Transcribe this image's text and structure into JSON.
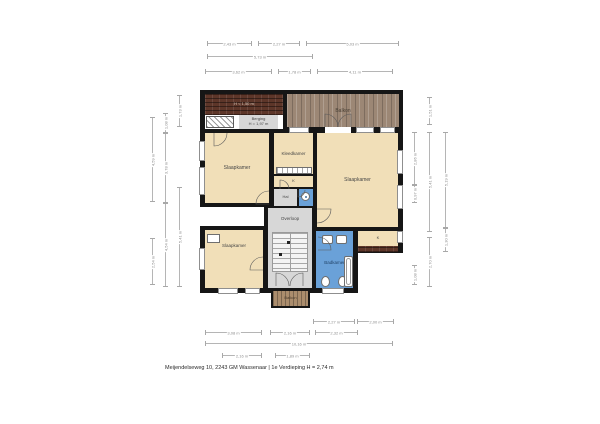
{
  "meta": {
    "footer": "Meijendelseweg 10, 2243 GM Wassenaar | 1e Verdieping H = 2,74 m"
  },
  "colors": {
    "wall": "#161616",
    "room": "#f1dfb8",
    "gray": "#d7d7d7",
    "blue": "#6aa1d8",
    "tile": "#5d3629",
    "wood": "#9c8775",
    "wood2": "#ab8d6d"
  },
  "walls": [
    {
      "x": 200,
      "y": 90,
      "w": 203,
      "h": 163
    },
    {
      "x": 200,
      "y": 250,
      "w": 158,
      "h": 43
    },
    {
      "x": 271,
      "y": 291,
      "w": 39,
      "h": 17
    }
  ],
  "areas": [
    {
      "name": "roof-low",
      "type": "tile",
      "x": 205,
      "y": 94,
      "w": 78,
      "h": 21,
      "label": "H < 1,50 m",
      "fs": 4,
      "lc": "#d8c8ba"
    },
    {
      "name": "storage-strip",
      "type": "plain-white",
      "x": 205,
      "y": 115,
      "w": 78,
      "h": 14
    },
    {
      "name": "berging",
      "type": "gray",
      "x": 239,
      "y": 115,
      "w": 39,
      "h": 14,
      "label": "Berging",
      "label2": "H = 1,97 m",
      "fs": 4
    },
    {
      "name": "balkon-top",
      "type": "wood",
      "x": 287,
      "y": 94,
      "w": 112,
      "h": 33,
      "label": "Balkon",
      "fs": 5,
      "lc": "#4a4136"
    },
    {
      "name": "slaapkamer-1",
      "type": "room",
      "x": 205,
      "y": 133,
      "w": 64,
      "h": 70,
      "label": "Slaapkamer",
      "fs": 5
    },
    {
      "name": "kleedkamer",
      "type": "room",
      "x": 274,
      "y": 133,
      "w": 39,
      "h": 41,
      "label": "Kleedkamer",
      "fs": 4.5
    },
    {
      "name": "kast-1",
      "type": "room",
      "x": 274,
      "y": 176,
      "w": 39,
      "h": 11,
      "label": "K",
      "fs": 4
    },
    {
      "name": "hal",
      "type": "gray",
      "x": 274,
      "y": 189,
      "w": 23,
      "h": 17,
      "label": "Hal",
      "fs": 4
    },
    {
      "name": "toilet",
      "type": "blue",
      "x": 299,
      "y": 189,
      "w": 14,
      "h": 17
    },
    {
      "name": "slaapkamer-2",
      "type": "room",
      "x": 317,
      "y": 133,
      "w": 81,
      "h": 94,
      "label": "Slaapkamer",
      "fs": 5
    },
    {
      "name": "exterior-notch",
      "type": "plain-white",
      "x": 200,
      "y": 207,
      "w": 64,
      "h": 19
    },
    {
      "name": "overloop",
      "type": "gray",
      "x": 268,
      "y": 208,
      "w": 44,
      "h": 80,
      "label": "Overloop",
      "fs": 4.5,
      "labelDy": -29
    },
    {
      "name": "slaapkamer-3",
      "type": "room",
      "x": 205,
      "y": 230,
      "w": 58,
      "h": 58,
      "label": "Slaapkamer",
      "fs": 4.5,
      "labelDy": -13
    },
    {
      "name": "badkamer",
      "type": "blue",
      "x": 316,
      "y": 231,
      "w": 37,
      "h": 57,
      "label": "Badkamer",
      "fs": 4.5,
      "labelDy": 3,
      "lc": "#24466b"
    },
    {
      "name": "kast-2",
      "type": "room",
      "x": 358,
      "y": 231,
      "w": 40,
      "h": 15,
      "label": "K",
      "fs": 4
    },
    {
      "name": "kast-2-roof",
      "type": "tile",
      "x": 358,
      "y": 246,
      "w": 40,
      "h": 6
    },
    {
      "name": "balkon-bottom",
      "type": "wood2",
      "x": 273,
      "y": 291,
      "w": 35,
      "h": 15,
      "label": "Balkon",
      "fs": 4,
      "lc": "#4a3c2c"
    }
  ],
  "fixtures": [
    {
      "type": "hatch",
      "x": 206,
      "y": 116,
      "w": 28,
      "h": 12
    },
    {
      "type": "closet",
      "x": 276,
      "y": 167,
      "w": 36,
      "h": 7
    },
    {
      "type": "circle",
      "x": 301,
      "y": 192,
      "w": 9,
      "h": 9
    },
    {
      "type": "box",
      "x": 207,
      "y": 234,
      "w": 13,
      "h": 9
    },
    {
      "type": "stairs",
      "x": 272,
      "y": 232,
      "w": 36,
      "h": 40
    },
    {
      "type": "dot",
      "x": 287,
      "y": 241,
      "w": 3,
      "h": 3
    },
    {
      "type": "dot",
      "x": 279,
      "y": 253,
      "w": 3,
      "h": 3
    },
    {
      "type": "roundbox",
      "x": 322,
      "y": 235,
      "w": 11,
      "h": 9
    },
    {
      "type": "roundbox",
      "x": 336,
      "y": 235,
      "w": 11,
      "h": 9
    },
    {
      "type": "oval",
      "x": 321,
      "y": 276,
      "w": 9,
      "h": 11
    },
    {
      "type": "oval",
      "x": 338,
      "y": 276,
      "w": 9,
      "h": 11
    },
    {
      "type": "tub",
      "x": 344,
      "y": 256,
      "w": 9,
      "h": 31
    }
  ],
  "windows": [
    {
      "x": 199,
      "y": 141,
      "w": 6,
      "h": 20
    },
    {
      "x": 199,
      "y": 167,
      "w": 6,
      "h": 28
    },
    {
      "x": 199,
      "y": 248,
      "w": 6,
      "h": 22
    },
    {
      "x": 218,
      "y": 288,
      "w": 20,
      "h": 6
    },
    {
      "x": 245,
      "y": 288,
      "w": 15,
      "h": 6
    },
    {
      "x": 322,
      "y": 288,
      "w": 22,
      "h": 6
    },
    {
      "x": 397,
      "y": 150,
      "w": 6,
      "h": 24
    },
    {
      "x": 397,
      "y": 185,
      "w": 6,
      "h": 24
    },
    {
      "x": 397,
      "y": 231,
      "w": 6,
      "h": 12
    },
    {
      "x": 289,
      "y": 127,
      "w": 20,
      "h": 6
    },
    {
      "x": 356,
      "y": 127,
      "w": 18,
      "h": 6
    },
    {
      "x": 380,
      "y": 127,
      "w": 15,
      "h": 6
    },
    {
      "x": 325,
      "y": 127,
      "w": 26,
      "h": 6,
      "frame": false
    }
  ],
  "doors": [
    {
      "name": "slaapkamer-1-top",
      "px": 214,
      "py": 133,
      "r": 13,
      "a0": 90,
      "a1": 0
    },
    {
      "name": "slaapkamer-1-hal",
      "px": 269,
      "py": 204,
      "r": 13,
      "a0": 180,
      "a1": 270
    },
    {
      "name": "balkon-left",
      "px": 325,
      "py": 127,
      "r": 13,
      "a0": 270,
      "a1": 360
    },
    {
      "name": "balkon-right",
      "px": 351,
      "py": 127,
      "r": 13,
      "a0": 270,
      "a1": 180
    },
    {
      "name": "slaapkamer-2",
      "px": 317,
      "py": 209,
      "r": 14,
      "a0": 0,
      "a1": 90
    },
    {
      "name": "badkamer",
      "px": 318,
      "py": 250,
      "r": 13,
      "a0": 0,
      "a1": -90
    },
    {
      "name": "slaapkamer-3",
      "px": 263,
      "py": 270,
      "r": 13,
      "a0": 180,
      "a1": 270
    },
    {
      "name": "balkon-b-left",
      "px": 276,
      "py": 286,
      "r": 13,
      "a0": 270,
      "a1": 360
    },
    {
      "name": "balkon-b-right",
      "px": 303,
      "py": 286,
      "r": 13,
      "a0": 270,
      "a1": 180
    },
    {
      "name": "toilet",
      "px": 298,
      "py": 190,
      "r": 7,
      "a0": 90,
      "a1": 0
    },
    {
      "name": "kleedkamer",
      "px": 280,
      "py": 189,
      "r": 9,
      "a0": 270,
      "a1": 360
    }
  ],
  "dims": [
    {
      "o": "h",
      "x": 207,
      "y": 43,
      "len": 45,
      "label": "2,43 m"
    },
    {
      "o": "h",
      "x": 258,
      "y": 43,
      "len": 42,
      "label": "2,27 m"
    },
    {
      "o": "h",
      "x": 306,
      "y": 43,
      "len": 93,
      "label": "5,03 m"
    },
    {
      "o": "h",
      "x": 207,
      "y": 56,
      "len": 106,
      "label": "5,73 m"
    },
    {
      "o": "h",
      "x": 205,
      "y": 71,
      "len": 67,
      "label": "3,62 m"
    },
    {
      "o": "h",
      "x": 278,
      "y": 71,
      "len": 33,
      "label": "1,78 m"
    },
    {
      "o": "h",
      "x": 317,
      "y": 71,
      "len": 76,
      "label": "4,11 m"
    },
    {
      "o": "h",
      "x": 313,
      "y": 321,
      "len": 42,
      "label": "2,27 m"
    },
    {
      "o": "h",
      "x": 357,
      "y": 321,
      "len": 37,
      "label": "2,00 m"
    },
    {
      "o": "h",
      "x": 205,
      "y": 332,
      "len": 57,
      "label": "3,08 m"
    },
    {
      "o": "h",
      "x": 270,
      "y": 332,
      "len": 40,
      "label": "2,16 m"
    },
    {
      "o": "h",
      "x": 315,
      "y": 332,
      "len": 43,
      "label": "2,32 m"
    },
    {
      "o": "h",
      "x": 205,
      "y": 343,
      "len": 188,
      "label": "10,16 m"
    },
    {
      "o": "h",
      "x": 222,
      "y": 355,
      "len": 40,
      "label": "2,16 m"
    },
    {
      "o": "h",
      "x": 275,
      "y": 355,
      "len": 35,
      "label": "1,89 m"
    },
    {
      "o": "v",
      "x": 152,
      "y": 117,
      "len": 85,
      "label": "4,59 m"
    },
    {
      "o": "v",
      "x": 152,
      "y": 238,
      "len": 47,
      "label": "2,54 m"
    },
    {
      "o": "v",
      "x": 165,
      "y": 113,
      "len": 20,
      "label": "1,08 m"
    },
    {
      "o": "v",
      "x": 165,
      "y": 133,
      "len": 70,
      "label": "3,78 m"
    },
    {
      "o": "v",
      "x": 165,
      "y": 203,
      "len": 84,
      "label": "4,54 m"
    },
    {
      "o": "v",
      "x": 179,
      "y": 95,
      "len": 32,
      "label": "1,73 m"
    },
    {
      "o": "v",
      "x": 179,
      "y": 187,
      "len": 100,
      "label": "5,41 m"
    },
    {
      "o": "v",
      "x": 414,
      "y": 132,
      "len": 53,
      "label": "2,86 m"
    },
    {
      "o": "v",
      "x": 414,
      "y": 185,
      "len": 18,
      "label": "0,97 m"
    },
    {
      "o": "v",
      "x": 414,
      "y": 265,
      "len": 20,
      "label": "1,08 m"
    },
    {
      "o": "v",
      "x": 429,
      "y": 97,
      "len": 28,
      "label": "1,51 m"
    },
    {
      "o": "v",
      "x": 429,
      "y": 132,
      "len": 100,
      "label": "5,41 m"
    },
    {
      "o": "v",
      "x": 429,
      "y": 237,
      "len": 50,
      "label": "2,70 m"
    },
    {
      "o": "v",
      "x": 445,
      "y": 132,
      "len": 96,
      "label": "5,19 m"
    },
    {
      "o": "v",
      "x": 445,
      "y": 228,
      "len": 24,
      "label": "1,30 m"
    }
  ]
}
